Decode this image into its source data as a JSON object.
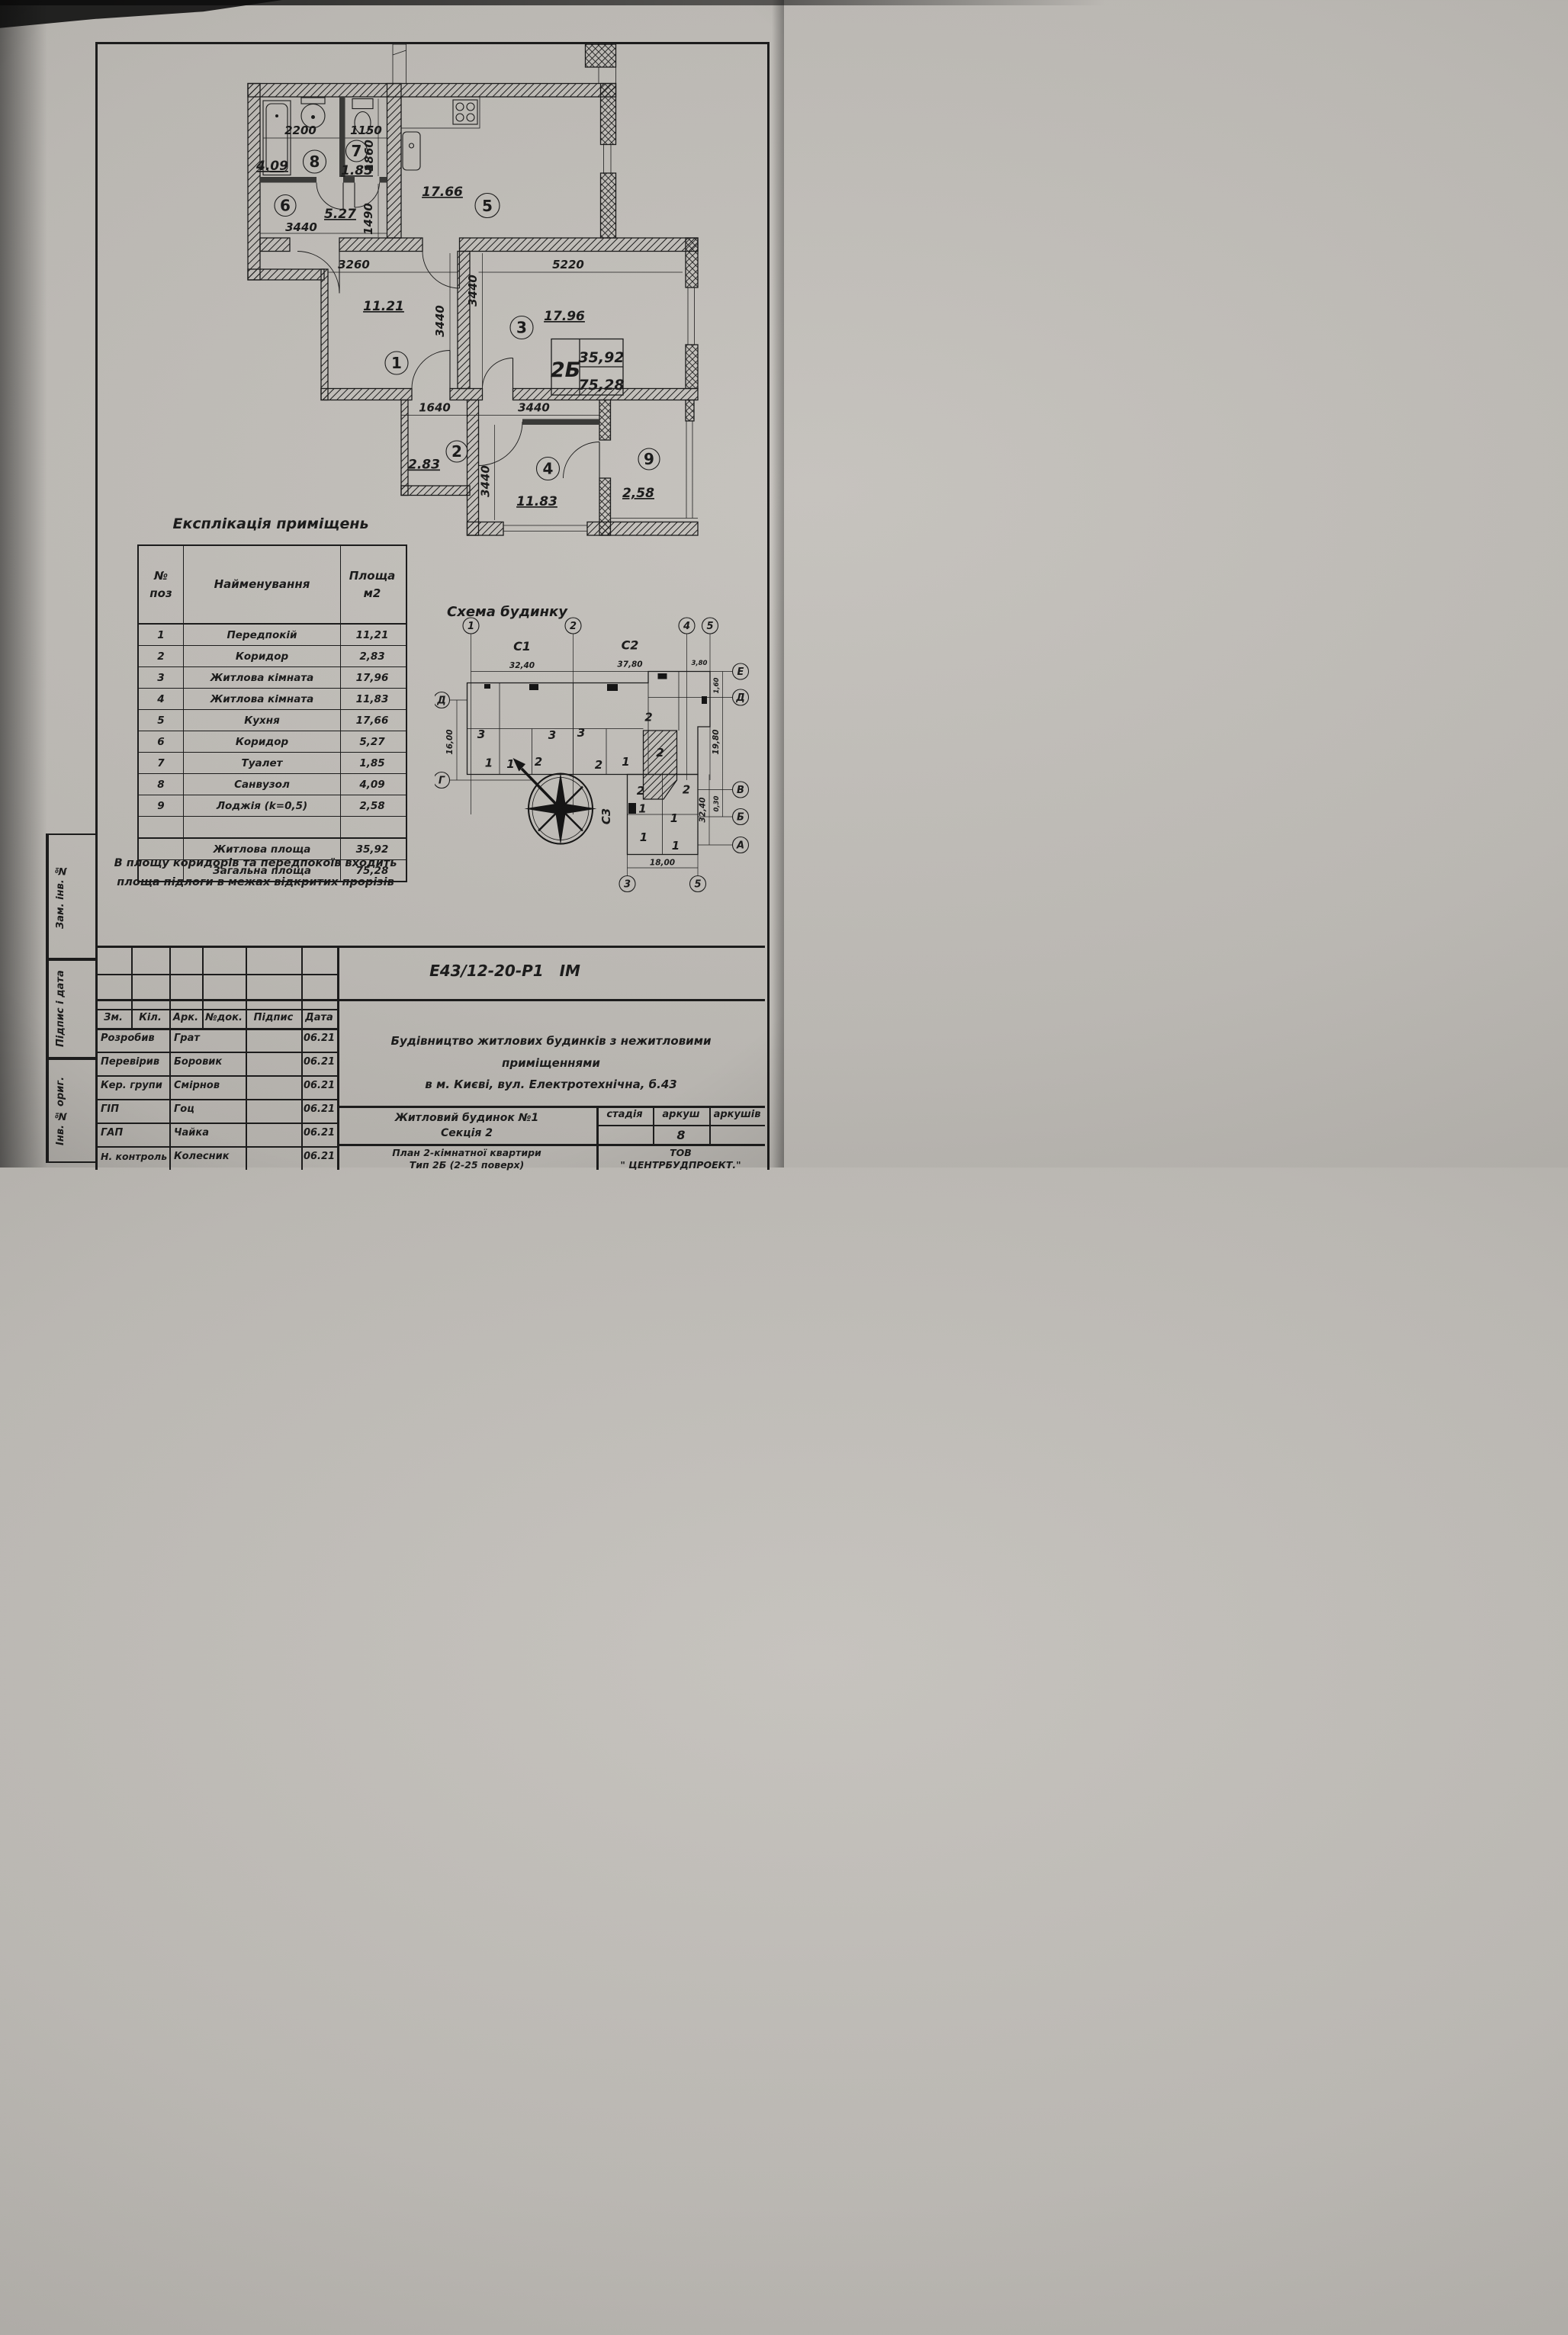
{
  "plan": {
    "apartment_stamp": {
      "type": "2Б",
      "living_area": "35,92",
      "total_area": "75,28"
    },
    "rooms": {
      "r1": {
        "num": "1",
        "area": "11.21"
      },
      "r2": {
        "num": "2",
        "area": "2.83"
      },
      "r3": {
        "num": "3",
        "area": "17.96"
      },
      "r4": {
        "num": "4",
        "area": "11.83"
      },
      "r5": {
        "num": "5",
        "area": "17.66"
      },
      "r6": {
        "num": "6",
        "area": "5.27"
      },
      "r7": {
        "num": "7",
        "area": "1.85"
      },
      "r8": {
        "num": "8",
        "area": "4.09"
      },
      "r9": {
        "num": "9",
        "area": "2,58"
      }
    },
    "dims": {
      "bath_width": "2200",
      "wc_width": "1150",
      "wc_depth": "1860",
      "hall6_width": "3440",
      "hall6_depth": "1490",
      "room1_width": "3260",
      "room1_depth": "3440",
      "room3_width": "5220",
      "room3_depth": "3440",
      "hall2_width": "1640",
      "room4_width": "3440",
      "room4_depth": "3440"
    }
  },
  "explication": {
    "title": "Експлікація приміщень",
    "header": {
      "num_line1": "№",
      "num_line2": "поз",
      "name": "Найменування",
      "area_line1": "Площа",
      "area_line2": "м2"
    },
    "rows": [
      {
        "num": "1",
        "name": "Передпокій",
        "area": "11,21"
      },
      {
        "num": "2",
        "name": "Коридор",
        "area": "2,83"
      },
      {
        "num": "3",
        "name": "Житлова кімната",
        "area": "17,96"
      },
      {
        "num": "4",
        "name": "Житлова кімната",
        "area": "11,83"
      },
      {
        "num": "5",
        "name": "Кухня",
        "area": "17,66"
      },
      {
        "num": "6",
        "name": "Коридор",
        "area": "5,27"
      },
      {
        "num": "7",
        "name": "Туалет",
        "area": "1,85"
      },
      {
        "num": "8",
        "name": "Санвузол",
        "area": "4,09"
      },
      {
        "num": "9",
        "name": "Лоджія (k=0,5)",
        "area": "2,58"
      }
    ],
    "totals": [
      {
        "name": "Житлова площа",
        "area": "35,92"
      },
      {
        "name": "Загальна площа",
        "area": "75,28"
      }
    ],
    "note_line1": "В площу коридорів та передпокоїв входить",
    "note_line2": "площа підлоги в межах відкритих прорізів"
  },
  "schema": {
    "title": "Схема будинку",
    "sections": {
      "c1": "С1",
      "c2": "С2",
      "c3": "С3"
    },
    "axes": {
      "top": [
        "1",
        "2",
        "4",
        "5"
      ],
      "bottom": [
        "3",
        "5"
      ],
      "right": [
        "Е",
        "Д",
        "В",
        "Б",
        "А"
      ],
      "left": [
        "Д",
        "Г"
      ]
    },
    "dims": {
      "c1_len": "32,40",
      "c2_len": "37,80",
      "right_offset": "3,80",
      "e_offset": "1,60",
      "right_depth": "19,80",
      "b_offset": "0,30",
      "left_depth": "16,00",
      "c3_width": "18,00",
      "c3_len": "32,40"
    },
    "units": [
      "3",
      "3",
      "3",
      "2",
      "1",
      "1",
      "2",
      "2",
      "1",
      "2",
      "2",
      "1",
      "2",
      "1",
      "1",
      "1"
    ]
  },
  "titleblock": {
    "doc_number": "Е43/12-20-Р1",
    "doc_code": "ІМ",
    "description_line1": "Будівництво житлових будинків з нежитловими приміщеннями",
    "description_line2": "в м. Києві, вул. Електротехнічна, б.43",
    "columns": [
      "Зм.",
      "Кіл.",
      "Арк.",
      "№док.",
      "Підпис",
      "Дата"
    ],
    "signatures": [
      {
        "role": "Розробив",
        "name": "Грат",
        "date": "06.21"
      },
      {
        "role": "Перевірив",
        "name": "Боровик",
        "date": "06.21"
      },
      {
        "role": "Кер. групи",
        "name": "Смірнов",
        "date": "06.21"
      },
      {
        "role": "ГІП",
        "name": "Гоц",
        "date": "06.21"
      },
      {
        "role": "ГАП",
        "name": "Чайка",
        "date": "06.21"
      },
      {
        "role": "Н. контроль",
        "name": "Колесник",
        "date": "06.21"
      }
    ],
    "object_line1": "Житловий будинок №1",
    "object_line2": "Секція 2",
    "sheet_title_line1": "План 2-кімнатної квартири",
    "sheet_title_line2": "Тип 2Б (2-25 поверх)",
    "stage_header": [
      "стадія",
      "аркуш",
      "аркушів"
    ],
    "sheet_number": "8",
    "company_line1": "ТОВ",
    "company_line2": "\" ЦЕНТРБУДПРОЕКТ.\"",
    "side_labels": [
      "Зам. інв. №",
      "Підпис і дата",
      "Інв. № ориг."
    ]
  }
}
